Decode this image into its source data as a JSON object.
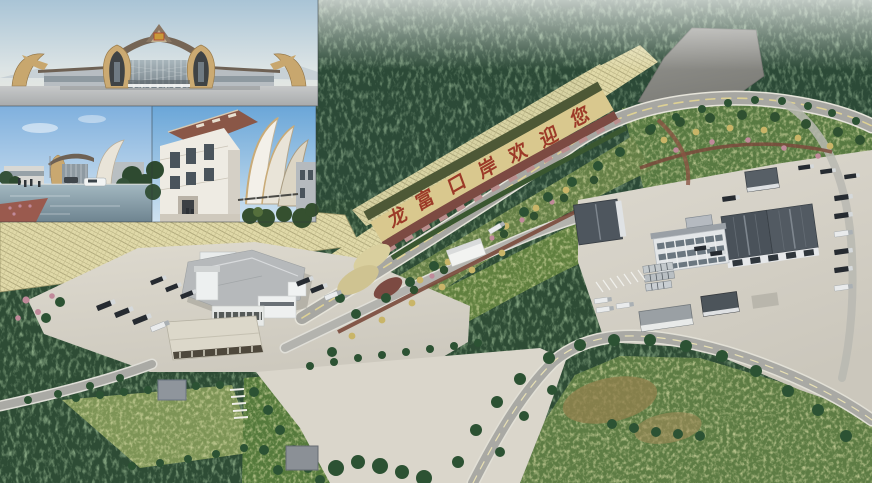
{
  "hillside_text": {
    "full": "龙富口岸欢迎您",
    "chars": [
      "龙",
      "富",
      "口",
      "岸",
      "欢",
      "迎",
      "您"
    ],
    "color": "#9c3a28"
  },
  "palette": {
    "forest_dark": "#2e4c35",
    "forest_speckle": "#6f9a5f",
    "garden_green": "#5f7f46",
    "pavement": "#d7d3c8",
    "road": "#a7a7a2",
    "flower_band_cream": "#d9c88e",
    "flower_band_olive": "#4d5836",
    "flower_band_maroon": "#7c4a42",
    "slope_mesh": "#e0d9a8",
    "cleared_ground": "#8b8b87",
    "warehouse_roof": "#4a525a",
    "building_wall": "#eceff0",
    "inset_sky": "#aec8d8",
    "inset_gold": "#c9a870"
  }
}
